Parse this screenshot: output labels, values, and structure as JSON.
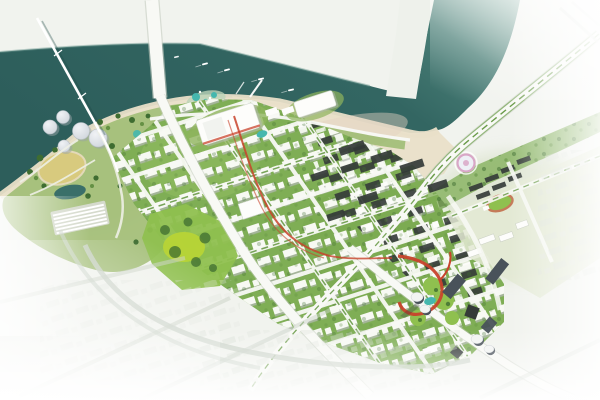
{
  "scene": {
    "kind": "aerial-city-masterplan-rendering",
    "water": {
      "name": "river-and-estuary",
      "boats": 5
    },
    "bridges": {
      "cable_bridge": "cable-stay-bridge",
      "main_bridge": "river-crossing-avenue-bridge"
    },
    "peninsula": {
      "name": "west-park-peninsula",
      "dome_pavilions": 5,
      "features": [
        "dome-pavilions",
        "yellow-field",
        "dark-pond",
        "greenhouse-rows",
        "waterpark-pools",
        "beach-rim"
      ]
    },
    "downtown": {
      "name": "central-district",
      "features": [
        "street-grid",
        "central-park",
        "convention-center",
        "exhibition-hall",
        "red-ribbon-walkway",
        "beachfront-sand",
        "dark-roof-blocks",
        "main-avenue"
      ]
    },
    "east": {
      "name": "east-district",
      "features": [
        "riverside-highway",
        "linear-park",
        "circular-plaza",
        "campus-sports-field",
        "ghost-blocks"
      ]
    },
    "cbd": {
      "name": "south-cbd-cluster",
      "white_top_towers": 4,
      "features": [
        "white-top-towers",
        "dark-towers",
        "red-ribbon-landmark",
        "teal-pond",
        "green-mounds"
      ]
    }
  },
  "palette": {
    "background": "#f1f3ee",
    "water": "#2d5e5b",
    "water_mid": "#336662",
    "water_fade": "#a3c2b8",
    "shore_glow": "#6b968d",
    "sand": "#e9dfc8",
    "sand_warm": "#e5d2c3",
    "peninsula_green": "#a4bf79",
    "lawn": "#7fae55",
    "lawn_light": "#8fba5f",
    "park_bright": "#8fc04f",
    "lime": "#b9d534",
    "tree": "#3f6d31",
    "tree_light": "#5d8c3e",
    "road": "#f8f9f5",
    "road_edge": "#c7cdc1",
    "median": "#6a9b49",
    "building": "#fdfdfb",
    "building_shadow": "#b2b8b0",
    "roof_dark": "#343a38",
    "red_accent": "#c8432c",
    "dome": "#ccd2d9",
    "dome_highlight": "#f0f2f5",
    "field_yellow": "#d8ca7e",
    "pond": "#3a6f69",
    "pool_teal": "#45b7ae",
    "tower": "#49525a",
    "tower_top": "#f2f4f2",
    "plaza": "#d9a7c7",
    "track": "#c57a58",
    "ghost_road": "#ccd3c9",
    "white": "#ffffff",
    "far_shore": "#eef1eb"
  }
}
